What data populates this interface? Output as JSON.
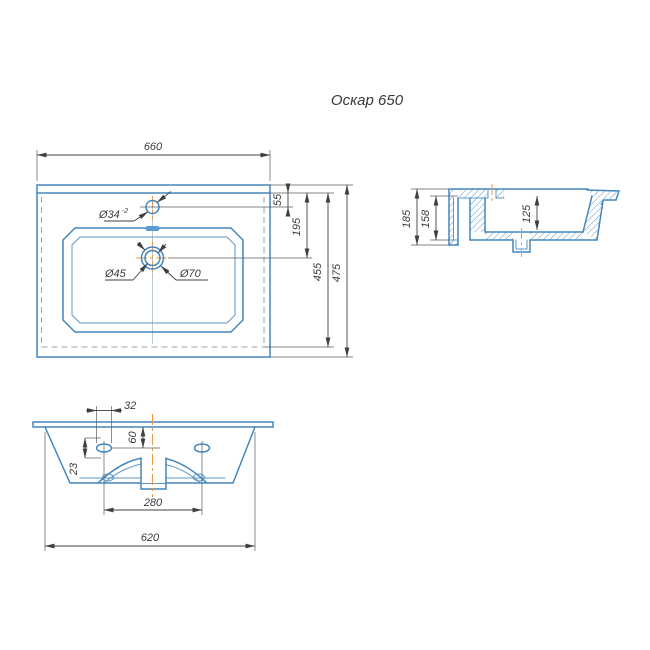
{
  "title": "Оскар 650",
  "colors": {
    "part_line": "#4486bd",
    "dimension_line": "#3f4043",
    "center_line": "#e59b4c",
    "hidden_line": "#97a5b4",
    "overflow_slot_fill": "#5b9bd5",
    "background": "#ffffff"
  },
  "views": {
    "top": {
      "width": "660",
      "rim_to_faucet": "55",
      "rim_to_drain": "195",
      "inner_depth": "455",
      "total_depth": "475",
      "faucet_dia": "Ø34",
      "faucet_tol": "-2",
      "drain_dia_inner": "Ø45",
      "drain_dia_outer": "Ø70"
    },
    "side": {
      "total_height": "185",
      "body_height": "158",
      "basin_depth": "125"
    },
    "front": {
      "hole_width": "32",
      "rim_to_hole": "60",
      "hole_height": "23",
      "hole_spacing": "280",
      "body_width": "620"
    }
  }
}
